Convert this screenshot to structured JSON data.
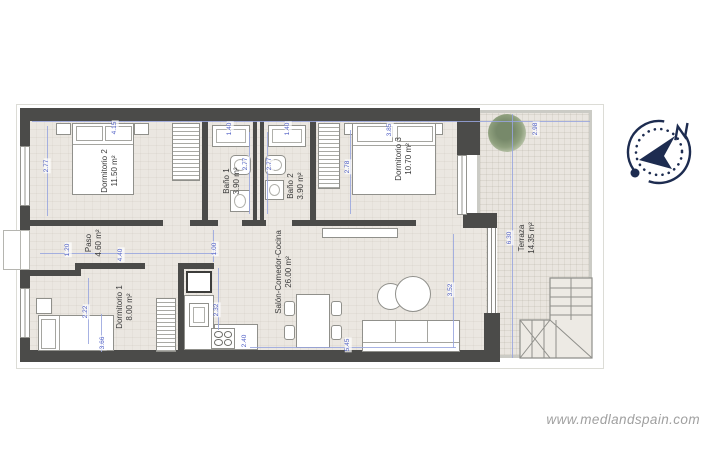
{
  "colors": {
    "wall": "#4b4b49",
    "floor": "#ebe7e1",
    "terrace": "#e9e5df",
    "dimline": "#98a5de",
    "dimtext": "#4e5ec5",
    "label": "#3a3a3a",
    "compass": "#1d2c50",
    "watermark": "#a0a0a0"
  },
  "watermark": {
    "text": "www.medlandspain.com"
  },
  "compass": {
    "north_label": "N"
  },
  "rooms": {
    "dormitorio2": {
      "name": "Dormitorio 2",
      "area": "11.50 m²"
    },
    "bano1": {
      "name": "Baño 1",
      "area": "3.90 m²"
    },
    "bano2": {
      "name": "Baño 2",
      "area": "3.90 m²"
    },
    "dormitorio3": {
      "name": "Dormitorio 3",
      "area": "10.70 m²"
    },
    "paso": {
      "name": "Paso",
      "area": "4.60 m²"
    },
    "dormitorio1": {
      "name": "Dormitorio 1",
      "area": "8.00 m²"
    },
    "salon": {
      "name": "Salón-Comedor-Cocina",
      "area": "26.00 m²"
    },
    "terraza": {
      "name": "Terraza",
      "area": "14.35 m²"
    }
  },
  "dimensions": [
    {
      "value": "4.15"
    },
    {
      "value": "1.40"
    },
    {
      "value": "1.40"
    },
    {
      "value": "3.85"
    },
    {
      "value": "2.98"
    },
    {
      "value": "2.77"
    },
    {
      "value": "2.77"
    },
    {
      "value": "2.77"
    },
    {
      "value": "2.78"
    },
    {
      "value": "6.30"
    },
    {
      "value": "1.20"
    },
    {
      "value": "4.40"
    },
    {
      "value": "1.00"
    },
    {
      "value": "2.22"
    },
    {
      "value": "3.66"
    },
    {
      "value": "2.32"
    },
    {
      "value": "2.40"
    },
    {
      "value": "3.52"
    },
    {
      "value": "5.45"
    }
  ]
}
